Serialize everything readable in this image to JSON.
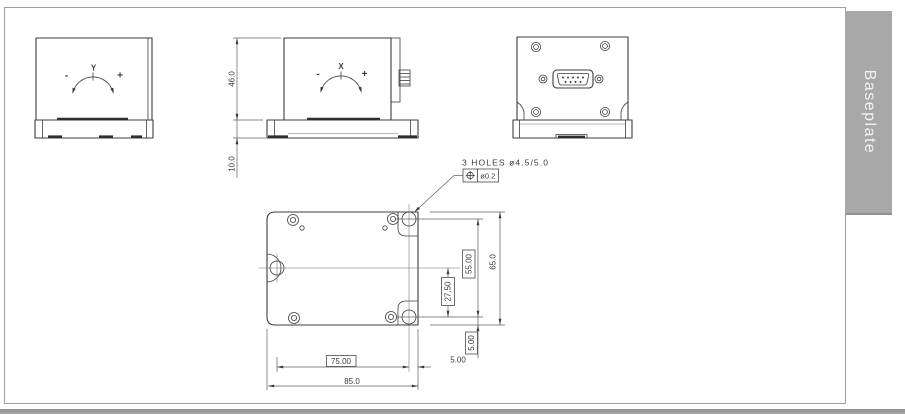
{
  "side_tab": {
    "label": "Baseplate",
    "bg": "#a8a8a8",
    "text_color": "#f2f2f2"
  },
  "sheet": {
    "border_color": "#9f9f9f",
    "bottom_bar_color": "#9c9c9c"
  },
  "views": {
    "front": {
      "axis": "Y",
      "minus": "-",
      "plus": "+"
    },
    "side": {
      "axis": "X",
      "minus": "-",
      "plus": "+",
      "dim_body_height": "46.0",
      "dim_base_height": "10.0"
    },
    "bottom": {
      "note": "3 HOLES ø4.5/5.0",
      "gdt": {
        "symbol": "position-tolerance",
        "tolerance": "ø0.2"
      },
      "dims": {
        "holes_vertical_span": "55.00",
        "plate_height": "65.0",
        "center_to_hole": "27.50",
        "hole_to_edge_vertical": "5.00",
        "holes_horizontal_span": "75.00",
        "hole_to_edge_horizontal": "5.00",
        "plate_width": "85.0"
      }
    }
  }
}
